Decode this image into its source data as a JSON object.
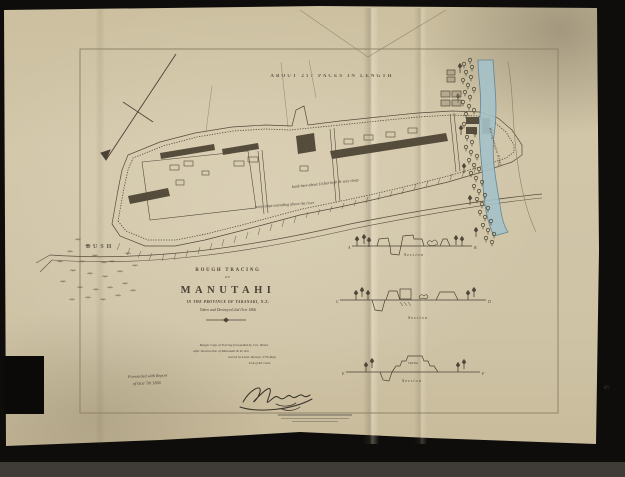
{
  "colors": {
    "paper": "#cfc3a6",
    "ink": "#4a4236",
    "handwriting": "#6b5f4b",
    "river_fill": "#a5c2c8",
    "river_edge": "#567f96",
    "frame_line": "#8a7e64",
    "background": "#0f0d0b"
  },
  "annotations": {
    "length_note": "ABOUT 217 PACES IN LENGTH",
    "bush": "BUSH",
    "bank_note": "bank here about 10 feet high & very steep",
    "slope_note": "steep slope extending above the river",
    "river_label": "Waingongoro River",
    "corner_mark": "43"
  },
  "title_block": {
    "rough_tracing": "ROUGH TRACING",
    "of": "OF",
    "name": "MANUTAHI",
    "province": "IN THE PROVINCE OF TARANAKI, N.Z.",
    "date": "Taken and Destroyed 2nd Octr 1866"
  },
  "note_block": {
    "line1": "Rough Copy of Tracing forwarded by Col. Weare",
    "line2": "after Destruction of Manutahi & Te Aru",
    "line3": "traced by Lieut. Rowan, 57th Regt",
    "line4": "D.A.Q.M. Genl."
  },
  "forwarded_note": {
    "line1": "Forwarded with Report",
    "line2": "of Octr 7th 1866"
  },
  "sections": {
    "s1": {
      "label": "Section",
      "left": "A",
      "right": "B"
    },
    "s2": {
      "label": "Section",
      "left": "C",
      "right": "D"
    },
    "s3": {
      "label": "Section",
      "left": "E",
      "right": "F",
      "feature": "Old Pa"
    }
  }
}
